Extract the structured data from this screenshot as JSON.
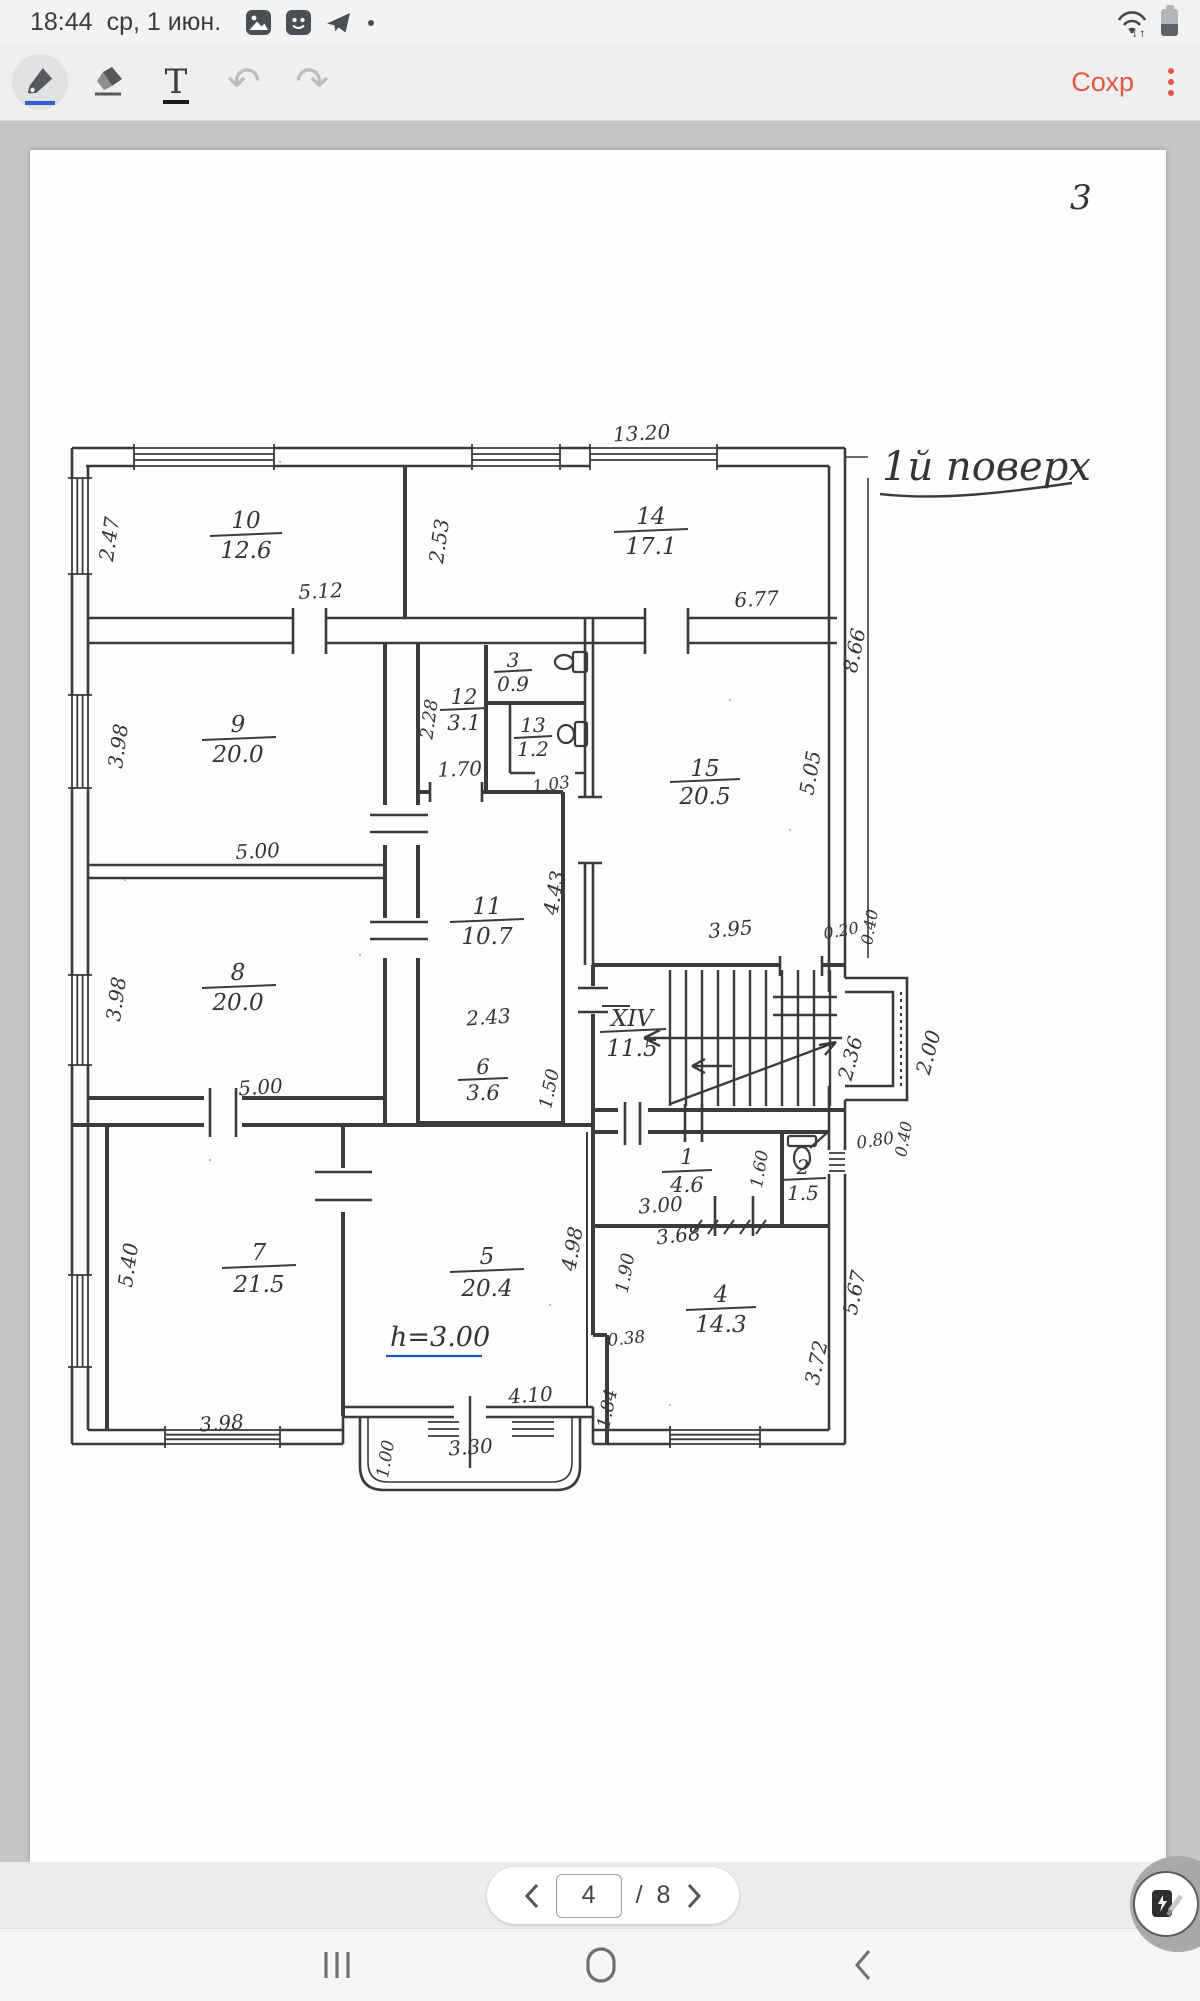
{
  "colors": {
    "accent_orange": "#e25746",
    "pen_blue": "#2f5fd0",
    "ink": "#3b3b3b",
    "note_blue": "#2857c8"
  },
  "status_bar": {
    "time": "18:44",
    "date": "ср, 1 июн.",
    "notification_icons": [
      "gallery-icon",
      "messenger-app-icon",
      "telegram-icon",
      "more-dot"
    ],
    "system_icons": [
      "wifi-icon",
      "battery-icon"
    ]
  },
  "toolbar": {
    "tools": [
      "pen",
      "eraser",
      "text",
      "undo",
      "redo"
    ],
    "text_tool_label": "T",
    "undo_glyph": "↶",
    "redo_glyph": "↷",
    "save_label": "Сохр"
  },
  "document": {
    "page_corner_number": "3",
    "floor_title": "1й поверх",
    "height_note": "h=3.00"
  },
  "plan": {
    "rooms": [
      {
        "number": "10",
        "area": "12.6"
      },
      {
        "number": "14",
        "area": "17.1"
      },
      {
        "number": "9",
        "area": "20.0"
      },
      {
        "number": "12",
        "area": "3.1"
      },
      {
        "number": "3",
        "area": "0.9"
      },
      {
        "number": "13",
        "area": "1.2"
      },
      {
        "number": "15",
        "area": "20.5"
      },
      {
        "number": "8",
        "area": "20.0"
      },
      {
        "number": "11",
        "area": "10.7"
      },
      {
        "number": "6",
        "area": "3.6"
      },
      {
        "number": "XIV",
        "area": "11.5"
      },
      {
        "number": "7",
        "area": "21.5"
      },
      {
        "number": "5",
        "area": "20.4"
      },
      {
        "number": "1",
        "area": "4.6"
      },
      {
        "number": "2",
        "area": "1.5"
      },
      {
        "number": "4",
        "area": "14.3"
      }
    ],
    "dims": [
      "13.20",
      "2.47",
      "5.12",
      "2.53",
      "6.77",
      "8.66",
      "2.28",
      "1.70",
      "1.03",
      "3.98",
      "5.00",
      "5.05",
      "3.95",
      "0.20",
      "0.40",
      "4.43",
      "2.43",
      "3.98",
      "5.00",
      "1.50",
      "2.36",
      "2.00",
      "0.40",
      "0.80",
      "1.60",
      "3.00",
      "3.68",
      "1.90",
      "0.38",
      "1.84",
      "3.72",
      "5.67",
      "5.40",
      "3.98",
      "4.98",
      "4.10",
      "1.00",
      "3.30"
    ]
  },
  "pagination": {
    "current_page": "4",
    "separator": "/",
    "total_pages": "8"
  },
  "nav_bar": {
    "buttons": [
      "recents",
      "home",
      "back"
    ]
  }
}
